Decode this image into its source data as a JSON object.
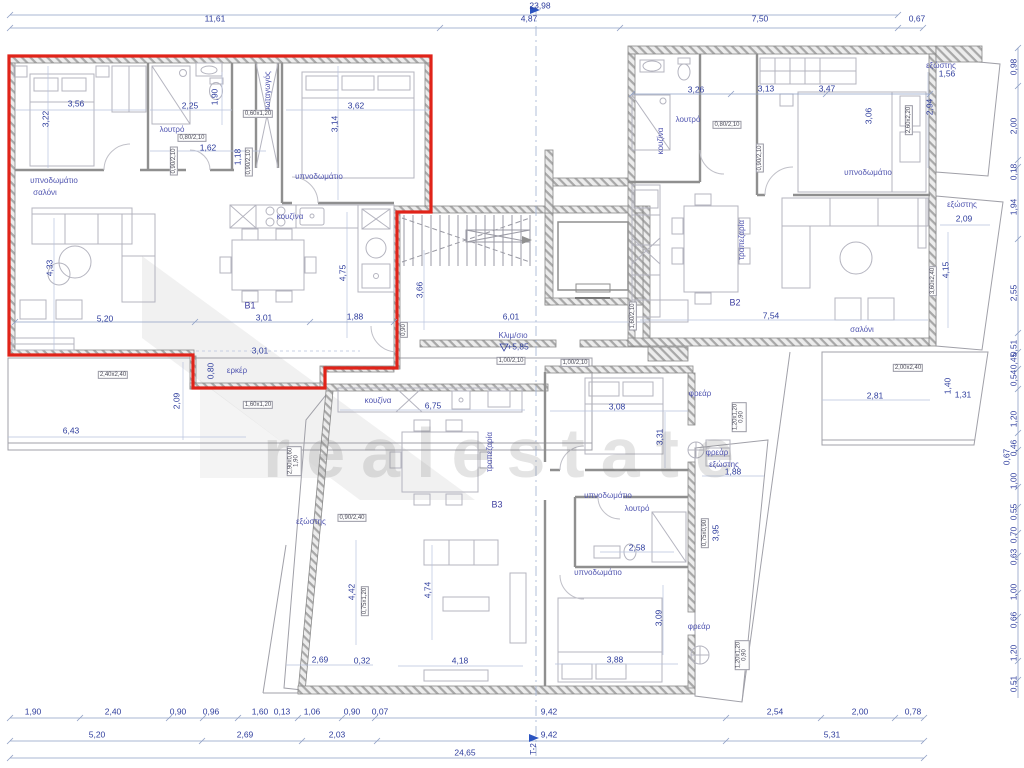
{
  "drawing": {
    "watermark": "realestate",
    "grid_axis": "T-2",
    "stair_label": "Κλιμ/σιο",
    "stair_level": "+5,85",
    "units": [
      "B1",
      "B2",
      "B3"
    ]
  },
  "labels": [
    {
      "t": "23,98",
      "x": 540,
      "y": 6
    },
    {
      "t": "11,61",
      "x": 215,
      "y": 19
    },
    {
      "t": "4,87",
      "x": 529,
      "y": 19
    },
    {
      "t": "7,50",
      "x": 760,
      "y": 19
    },
    {
      "t": "0,67",
      "x": 917,
      "y": 19
    },
    {
      "t": "3,56",
      "x": 76,
      "y": 104
    },
    {
      "t": "3,22",
      "x": 46,
      "y": 119,
      "r": -90
    },
    {
      "t": "2,25",
      "x": 190,
      "y": 106
    },
    {
      "t": "1,90",
      "x": 215,
      "y": 97,
      "r": -90
    },
    {
      "t": "λουτρό",
      "x": 172,
      "y": 130,
      "c": "room"
    },
    {
      "t": "0,80/2,10",
      "x": 192,
      "y": 138,
      "c": "tag"
    },
    {
      "t": "1,62",
      "x": 208,
      "y": 148
    },
    {
      "t": "0,90/2,10",
      "x": 174,
      "y": 161,
      "c": "tag",
      "r": -90
    },
    {
      "t": "υπνοδωμάτιο",
      "x": 54,
      "y": 181,
      "c": "room"
    },
    {
      "t": "σαλόνι",
      "x": 45,
      "y": 193,
      "c": "room"
    },
    {
      "t": "φωταγωγός",
      "x": 268,
      "y": 92,
      "c": "room",
      "r": -90
    },
    {
      "t": "0,60x1,20",
      "x": 258,
      "y": 114,
      "c": "tag"
    },
    {
      "t": "1,18",
      "x": 238,
      "y": 157,
      "r": -90
    },
    {
      "t": "0,90/2,10",
      "x": 249,
      "y": 162,
      "c": "tag",
      "r": -90
    },
    {
      "t": "3,62",
      "x": 356,
      "y": 106
    },
    {
      "t": "3,14",
      "x": 335,
      "y": 124,
      "r": -90
    },
    {
      "t": "υπνοδωμάτιο",
      "x": 319,
      "y": 177,
      "c": "room"
    },
    {
      "t": "κουζίνα",
      "x": 290,
      "y": 217,
      "c": "room"
    },
    {
      "t": "4,75",
      "x": 343,
      "y": 273,
      "r": -90
    },
    {
      "t": "B1",
      "x": 250,
      "y": 306,
      "c": "unit"
    },
    {
      "t": "4,33",
      "x": 50,
      "y": 268,
      "r": -90
    },
    {
      "t": "5,20",
      "x": 105,
      "y": 319
    },
    {
      "t": "3,01",
      "x": 264,
      "y": 318
    },
    {
      "t": "1,88",
      "x": 355,
      "y": 317
    },
    {
      "t": "0,90",
      "x": 404,
      "y": 330,
      "c": "tag",
      "r": -90
    },
    {
      "t": "3,01",
      "x": 260,
      "y": 351
    },
    {
      "t": "0,80",
      "x": 211,
      "y": 371,
      "r": -90
    },
    {
      "t": "ερκέρ",
      "x": 237,
      "y": 371,
      "c": "room"
    },
    {
      "t": "2,40x2,40",
      "x": 113,
      "y": 375,
      "c": "tag"
    },
    {
      "t": "2,09",
      "x": 177,
      "y": 401,
      "r": -90
    },
    {
      "t": "1,60x1,20",
      "x": 258,
      "y": 405,
      "c": "tag"
    },
    {
      "t": "6,43",
      "x": 71,
      "y": 431
    },
    {
      "t": "2,90x0,60",
      "t2": "1,90",
      "x": 294,
      "y": 461,
      "c": "tag",
      "r": -90
    },
    {
      "t": "εξώστης",
      "x": 311,
      "y": 522,
      "c": "room"
    },
    {
      "t": "0,90/2,40",
      "x": 352,
      "y": 518,
      "c": "tag"
    },
    {
      "t": "3,66",
      "x": 420,
      "y": 290,
      "r": -90
    },
    {
      "t": "6,01",
      "x": 511,
      "y": 317
    },
    {
      "t": "Κλιμ/σιο",
      "x": 513,
      "y": 336,
      "c": "room"
    },
    {
      "t": "+5,85",
      "x": 518,
      "y": 347
    },
    {
      "t": "1,00/2,10",
      "x": 511,
      "y": 361,
      "c": "tag"
    },
    {
      "t": "1,00/2,10",
      "x": 575,
      "y": 363,
      "c": "tag"
    },
    {
      "t": "1,60/2,10",
      "x": 633,
      "y": 316,
      "c": "tag",
      "r": -90
    },
    {
      "t": "3,26",
      "x": 696,
      "y": 90
    },
    {
      "t": "3,13",
      "x": 766,
      "y": 89
    },
    {
      "t": "3,47",
      "x": 827,
      "y": 89
    },
    {
      "t": "λουτρό",
      "x": 688,
      "y": 120,
      "c": "room"
    },
    {
      "t": "0,80/2,10",
      "x": 727,
      "y": 125,
      "c": "tag"
    },
    {
      "t": "κουζίνα",
      "x": 661,
      "y": 141,
      "c": "room",
      "r": -90
    },
    {
      "t": "0,90/2,10",
      "x": 760,
      "y": 158,
      "c": "tag",
      "r": -90
    },
    {
      "t": "υπνοδωμάτιο",
      "x": 868,
      "y": 173,
      "c": "room"
    },
    {
      "t": "3,06",
      "x": 869,
      "y": 116,
      "r": -90
    },
    {
      "t": "2,60x2,20",
      "x": 909,
      "y": 120,
      "c": "tag",
      "r": -90
    },
    {
      "t": "τραπεζαρία",
      "x": 742,
      "y": 240,
      "c": "room",
      "r": -90
    },
    {
      "t": "B2",
      "x": 735,
      "y": 303,
      "c": "unit"
    },
    {
      "t": "7,54",
      "x": 771,
      "y": 316
    },
    {
      "t": "σαλόνι",
      "x": 862,
      "y": 330,
      "c": "room"
    },
    {
      "t": "εξώστης",
      "x": 941,
      "y": 66,
      "c": "room"
    },
    {
      "t": "1,56",
      "x": 947,
      "y": 74
    },
    {
      "t": "2,94",
      "x": 930,
      "y": 107,
      "r": -90
    },
    {
      "t": "εξώστης",
      "x": 962,
      "y": 205,
      "c": "room"
    },
    {
      "t": "2,09",
      "x": 964,
      "y": 219
    },
    {
      "t": "4,15",
      "x": 946,
      "y": 270,
      "r": -90
    },
    {
      "t": "3,60x2,40",
      "x": 933,
      "y": 281,
      "c": "tag",
      "r": -90
    },
    {
      "t": "1,40",
      "x": 948,
      "y": 386,
      "r": -90
    },
    {
      "t": "1,31",
      "x": 963,
      "y": 395
    },
    {
      "t": "2,81",
      "x": 875,
      "y": 396
    },
    {
      "t": "2,00x2,40",
      "x": 908,
      "y": 368,
      "c": "tag"
    },
    {
      "t": "0,98",
      "x": 1014,
      "y": 67,
      "r": -90
    },
    {
      "t": "2,00",
      "x": 1014,
      "y": 126,
      "r": -90
    },
    {
      "t": "0,18",
      "x": 1014,
      "y": 172,
      "r": -90
    },
    {
      "t": "1,94",
      "x": 1014,
      "y": 207,
      "r": -90
    },
    {
      "t": "2,55",
      "x": 1014,
      "y": 293,
      "r": -90
    },
    {
      "t": "0,51",
      "x": 1014,
      "y": 348,
      "r": -90
    },
    {
      "t": "0,45",
      "x": 1014,
      "y": 361,
      "r": -90
    },
    {
      "t": "0,54",
      "x": 1014,
      "y": 378,
      "r": -90
    },
    {
      "t": "1,20",
      "x": 1014,
      "y": 419,
      "r": -90
    },
    {
      "t": "0,46",
      "x": 1014,
      "y": 448,
      "r": -90
    },
    {
      "t": "0,67",
      "x": 1007,
      "y": 457,
      "r": -90
    },
    {
      "t": "1,00",
      "x": 1014,
      "y": 481,
      "r": -90
    },
    {
      "t": "0,55",
      "x": 1014,
      "y": 512,
      "r": -90
    },
    {
      "t": "0,70",
      "x": 1014,
      "y": 535,
      "r": -90
    },
    {
      "t": "0,63",
      "x": 1014,
      "y": 557,
      "r": -90
    },
    {
      "t": "1,00",
      "x": 1014,
      "y": 592,
      "r": -90
    },
    {
      "t": "0,66",
      "x": 1014,
      "y": 620,
      "r": -90
    },
    {
      "t": "1,20",
      "x": 1014,
      "y": 653,
      "r": -90
    },
    {
      "t": "0,51",
      "x": 1014,
      "y": 684,
      "r": -90
    },
    {
      "t": "κουζίνα",
      "x": 378,
      "y": 401,
      "c": "room"
    },
    {
      "t": "6,75",
      "x": 433,
      "y": 406
    },
    {
      "t": "τραπεζαρία",
      "x": 490,
      "y": 452,
      "c": "room",
      "r": -90
    },
    {
      "t": "B3",
      "x": 497,
      "y": 505,
      "c": "unit"
    },
    {
      "t": "3,08",
      "x": 617,
      "y": 407
    },
    {
      "t": "3,31",
      "x": 660,
      "y": 437,
      "r": -90
    },
    {
      "t": "φρεάρ",
      "x": 700,
      "y": 394,
      "c": "room"
    },
    {
      "t": "φρεάρ",
      "x": 717,
      "y": 453,
      "c": "room"
    },
    {
      "t": "υπνοδωμάτιο",
      "x": 608,
      "y": 496,
      "c": "room"
    },
    {
      "t": "λουτρό",
      "x": 637,
      "y": 509,
      "c": "room"
    },
    {
      "t": "2,58",
      "x": 637,
      "y": 548
    },
    {
      "t": "υπνοδωμάτιο",
      "x": 598,
      "y": 573,
      "c": "room"
    },
    {
      "t": "3,88",
      "x": 615,
      "y": 660
    },
    {
      "t": "3,09",
      "x": 659,
      "y": 618,
      "r": -90
    },
    {
      "t": "φρεάρ",
      "x": 699,
      "y": 627,
      "c": "room"
    },
    {
      "t": "εξώστης",
      "x": 724,
      "y": 465,
      "c": "room"
    },
    {
      "t": "1,88",
      "x": 733,
      "y": 472
    },
    {
      "t": "3,95",
      "x": 716,
      "y": 533,
      "r": -90
    },
    {
      "t": "0,75x0,90",
      "x": 705,
      "y": 533,
      "c": "tag",
      "r": -90
    },
    {
      "t": "4,42",
      "x": 352,
      "y": 592,
      "r": -90
    },
    {
      "t": "0,75x1,20",
      "x": 365,
      "y": 601,
      "c": "tag",
      "r": -90
    },
    {
      "t": "4,74",
      "x": 428,
      "y": 590,
      "r": -90
    },
    {
      "t": "2,69",
      "x": 320,
      "y": 660
    },
    {
      "t": "0,32",
      "x": 362,
      "y": 661
    },
    {
      "t": "4,18",
      "x": 460,
      "y": 661
    },
    {
      "t": "1,20x1,20",
      "t2": "0,90",
      "x": 739,
      "y": 417,
      "c": "tag",
      "r": -90
    },
    {
      "t": "1,20x1,20",
      "t2": "0,90",
      "x": 742,
      "y": 655,
      "c": "tag",
      "r": -90
    },
    {
      "t": "1,90",
      "x": 33,
      "y": 712
    },
    {
      "t": "2,40",
      "x": 113,
      "y": 712
    },
    {
      "t": "0,90",
      "x": 178,
      "y": 712
    },
    {
      "t": "0,96",
      "x": 211,
      "y": 712
    },
    {
      "t": "1,60",
      "x": 260,
      "y": 712
    },
    {
      "t": "0,13",
      "x": 282,
      "y": 712
    },
    {
      "t": "1,06",
      "x": 312,
      "y": 712
    },
    {
      "t": "0,90",
      "x": 352,
      "y": 712
    },
    {
      "t": "0,07",
      "x": 380,
      "y": 712
    },
    {
      "t": "9,42",
      "x": 549,
      "y": 712
    },
    {
      "t": "2,54",
      "x": 775,
      "y": 712
    },
    {
      "t": "2,00",
      "x": 860,
      "y": 712
    },
    {
      "t": "0,78",
      "x": 913,
      "y": 712
    },
    {
      "t": "5,20",
      "x": 97,
      "y": 735
    },
    {
      "t": "2,69",
      "x": 245,
      "y": 735
    },
    {
      "t": "2,03",
      "x": 337,
      "y": 735
    },
    {
      "t": "9,42",
      "x": 549,
      "y": 735
    },
    {
      "t": "5,31",
      "x": 832,
      "y": 735
    },
    {
      "t": "24,65",
      "x": 465,
      "y": 753
    },
    {
      "t": "T-2",
      "x": 534,
      "y": 749,
      "c": "axis",
      "r": -90
    }
  ]
}
